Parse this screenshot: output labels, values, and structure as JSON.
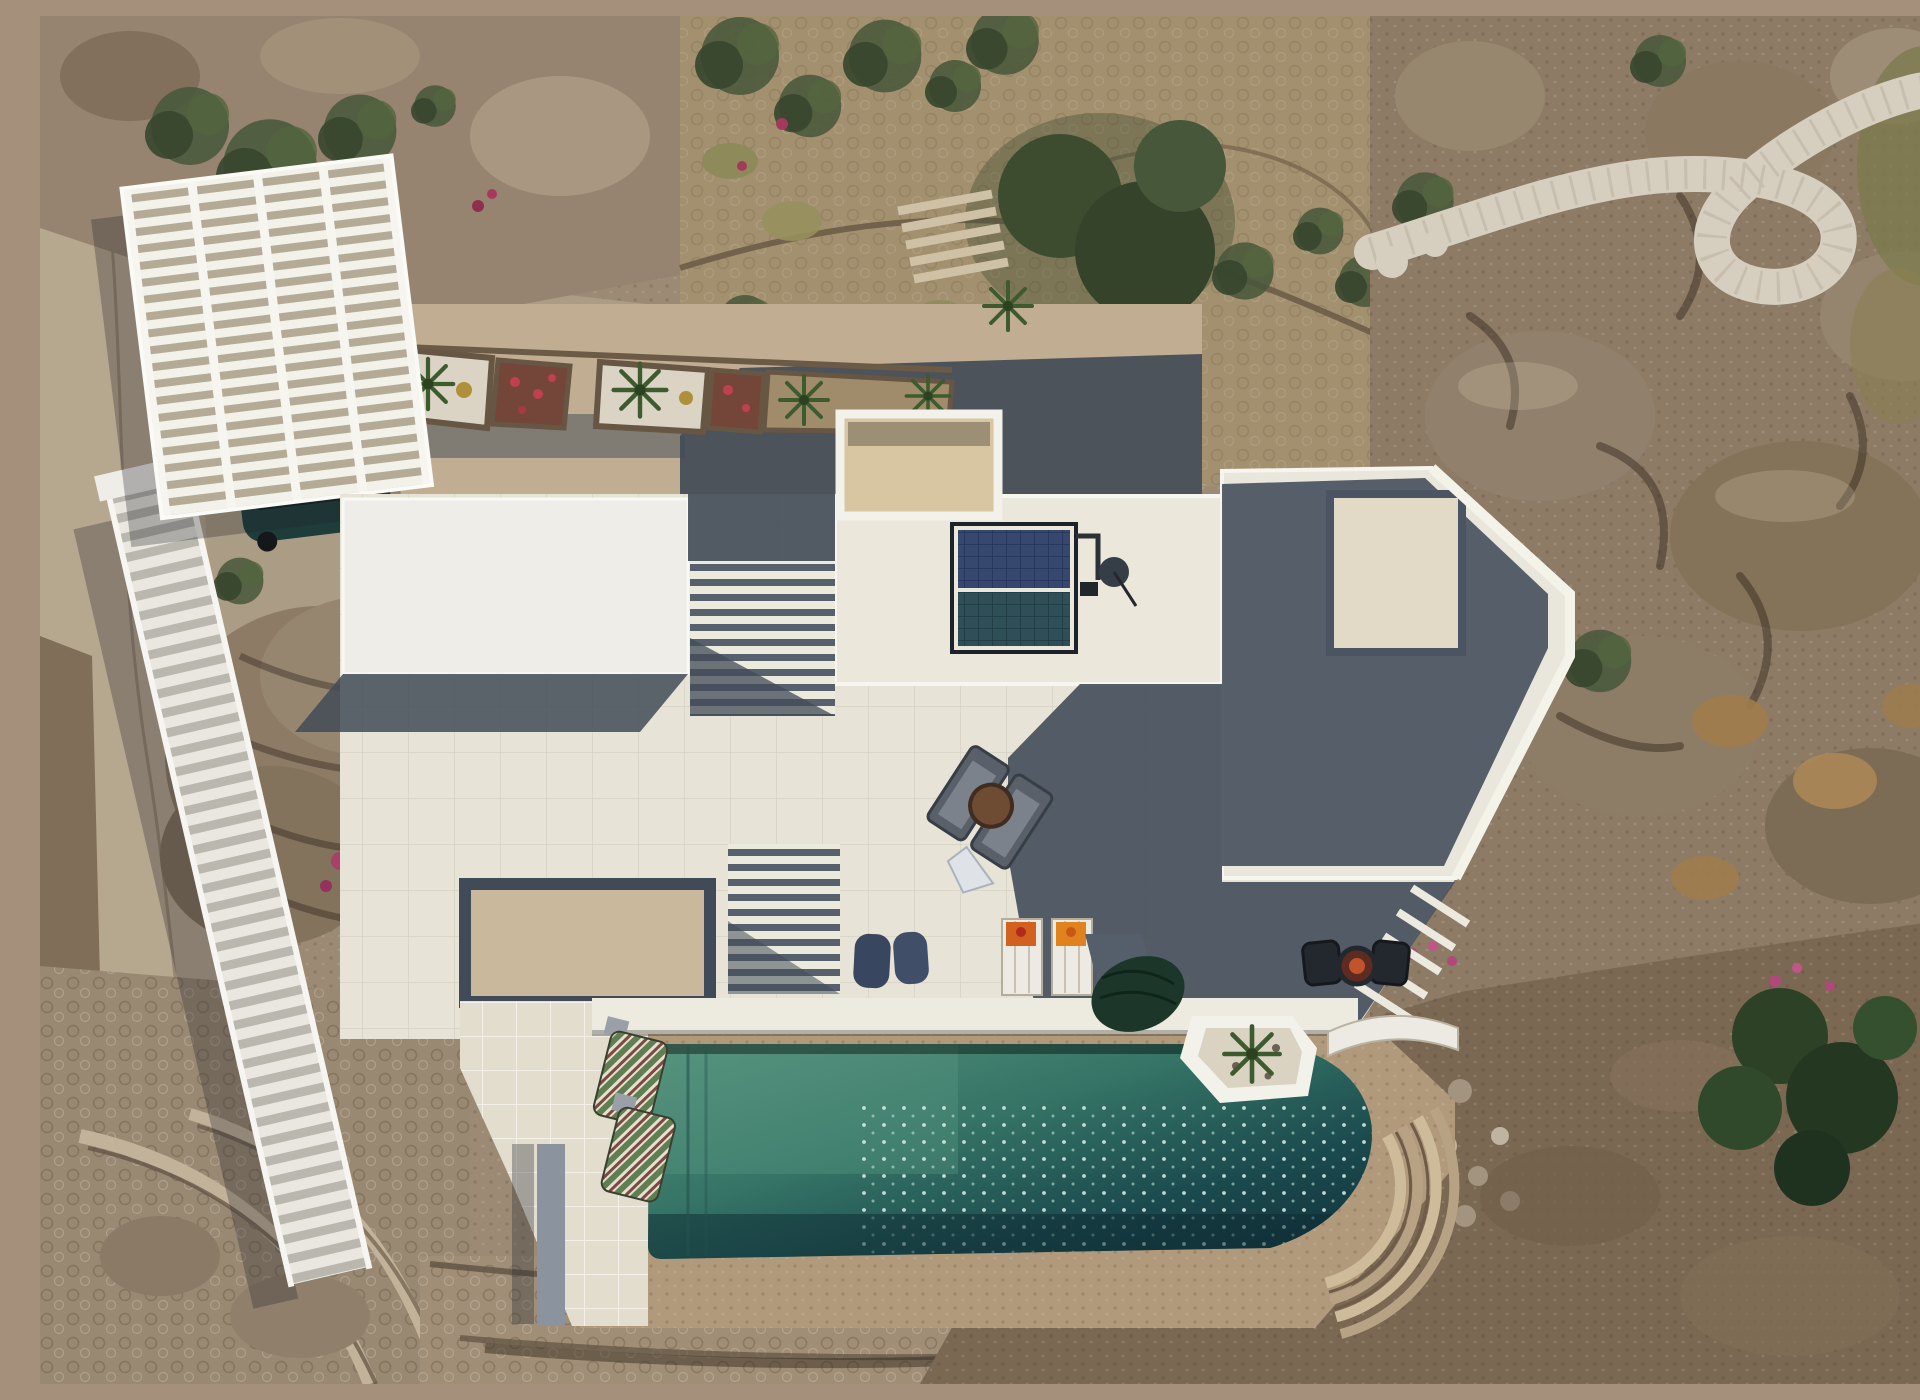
{
  "scene": {
    "description": "Top-down aerial drone photograph of a white flat-roofed villa on a rocky hillside: rooftop solar water heater, sun terraces with loungers, dark teal swimming pool with sparkling water, white slatted pergola carport with a parked dark car, white stair walkway, stone garden terraces with shrubs and palms, a winding white pebble path through boulders, a dirt road on the left and a bare soil slope at lower right."
  },
  "palette": {
    "villa_white": "#efede8",
    "terrace_tile": "#e7e3d6",
    "parapet_white": "#f6f5f0",
    "shadow_blue_gray": "#414b57",
    "courtyard_beige": "#c0ad92",
    "pool_teal_light": "#55907c",
    "pool_teal_dark": "#10303a",
    "terracotta_deck": "#b19a7c",
    "dirt_road": "#b6a78f",
    "rock_brown": "#8f7d68",
    "soil_slope_brown": "#7b6853",
    "pebble_path_white": "#d6cfc0",
    "vegetation_green": "#47573a",
    "bougainvillea_pink": "#b2487a",
    "solar_panel_blue": "#36486e",
    "solar_panel_teal": "#2e4f58",
    "car_body_teal": "#1e3c39",
    "umbrella_green": "#1c372a",
    "beanbag_navy": "#39465f",
    "towel_orange": "#d2601f",
    "lounger_gray": "#596069",
    "firepit_rust": "#c2542c"
  },
  "objects": [
    {
      "name": "carport-pergola",
      "label": "white slatted pergola carport"
    },
    {
      "name": "parked-car",
      "label": "dark teal car under pergola"
    },
    {
      "name": "stair-walkway",
      "label": "white slatted stair walkway"
    },
    {
      "name": "entry-atrium",
      "label": "roof opening over entry with beige floor"
    },
    {
      "name": "solar-water-heater",
      "label": "rooftop solar panel assembly"
    },
    {
      "name": "roof-terrace",
      "label": "white tiled roof terrace"
    },
    {
      "name": "roof-loungers",
      "label": "pair of gray loungers with round table"
    },
    {
      "name": "swimming-pool",
      "label": "teal swimming pool with curved end"
    },
    {
      "name": "bean-bags",
      "label": "two navy bean bags"
    },
    {
      "name": "pool-loungers",
      "label": "white loungers with orange towels"
    },
    {
      "name": "patio-umbrella",
      "label": "closed dark green umbrella"
    },
    {
      "name": "fire-pit-set",
      "label": "two black chairs and rust fire pit"
    },
    {
      "name": "planter-box",
      "label": "white planter with yucca"
    },
    {
      "name": "striped-loungers",
      "label": "green striped loungers"
    },
    {
      "name": "garden-terraces",
      "label": "stone walled garden terraces"
    },
    {
      "name": "pebble-path",
      "label": "winding white pebble path"
    },
    {
      "name": "boulder-field",
      "label": "granite boulders"
    },
    {
      "name": "dirt-road",
      "label": "dirt road and parking"
    },
    {
      "name": "soil-slope",
      "label": "bare brown soil slope"
    }
  ]
}
